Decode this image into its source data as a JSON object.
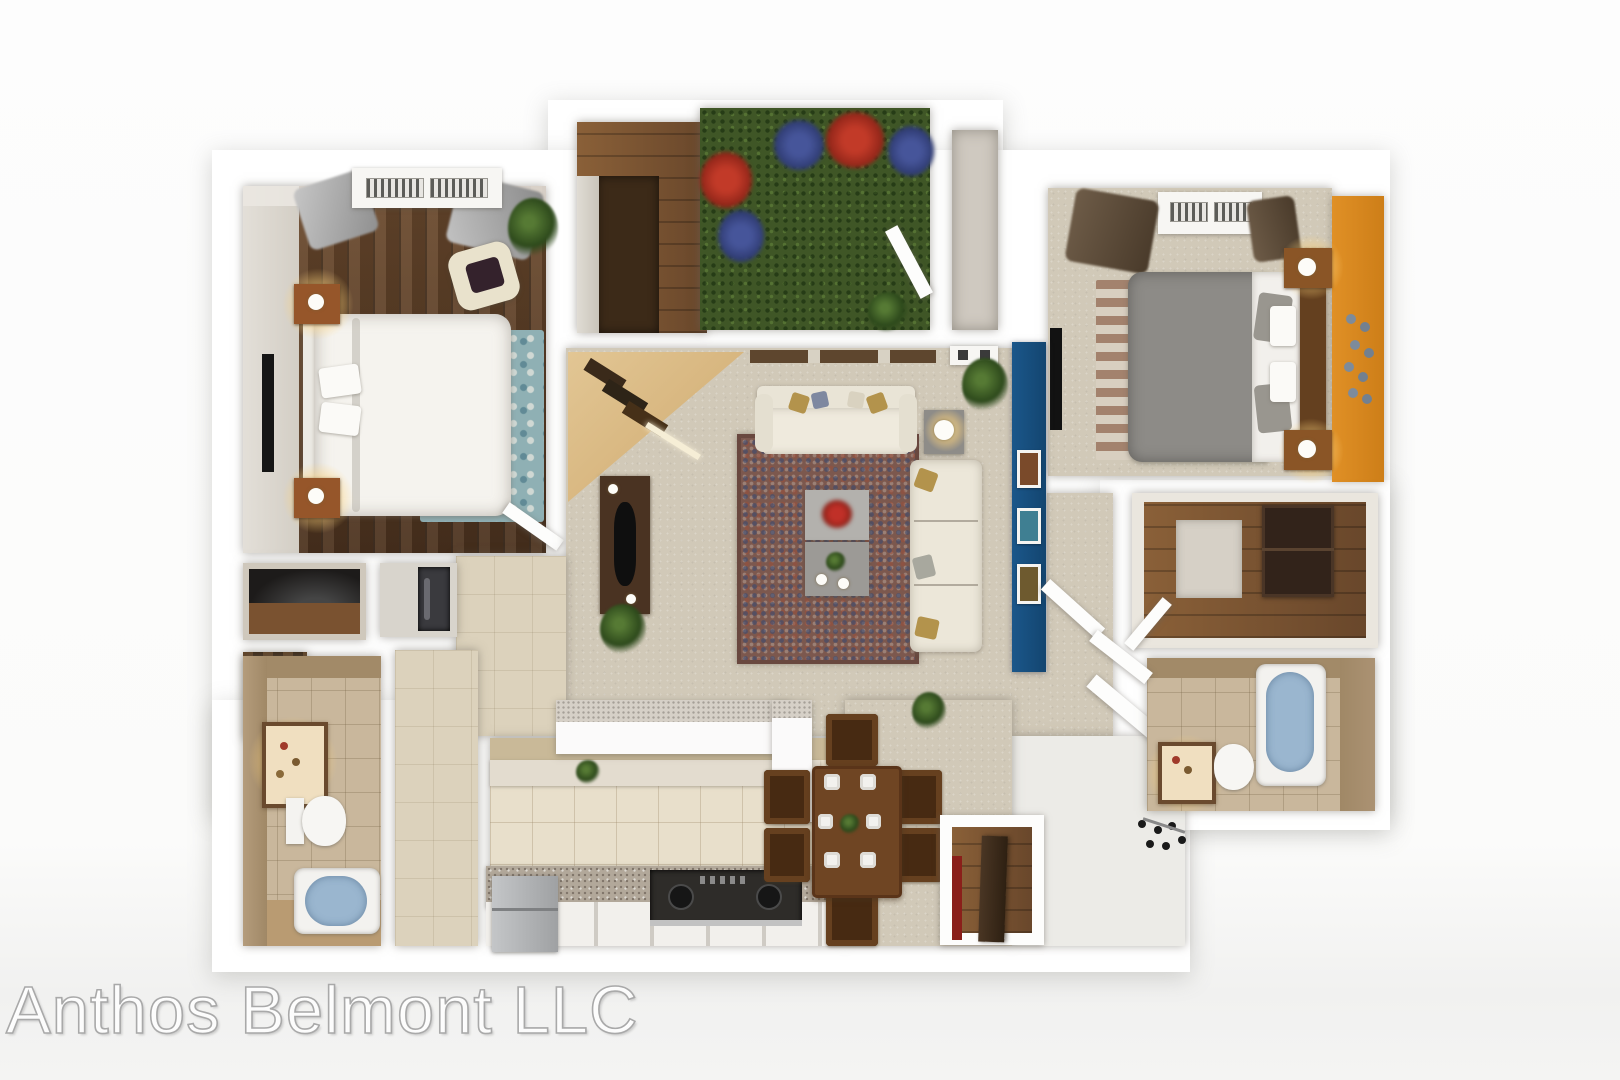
{
  "watermark": {
    "text": "Anthos Belmont LLC"
  },
  "plan": {
    "type": "3d-apartment-floor-plan",
    "bedrooms": 2,
    "bathrooms": 2,
    "rooms": [
      {
        "name": "master-bedroom",
        "floor": "dark wood plank",
        "fixtures": [
          "dresser",
          "curtains",
          "tv",
          "king-bed",
          "nightstand-with-lamp",
          "nightstand-with-lamp",
          "armchair",
          "teal-rug",
          "plant"
        ]
      },
      {
        "name": "laundry-closet",
        "floor": "medium wood",
        "fixtures": [
          "counter"
        ]
      },
      {
        "name": "patio",
        "floor": "grass",
        "fixtures": [
          "flower-bushes-red",
          "flower-bushes-blue",
          "patio-door"
        ]
      },
      {
        "name": "storage-closet",
        "floor": "gray tile",
        "fixtures": []
      },
      {
        "name": "bedroom-2",
        "floor": "beige carpet",
        "accent_wall": "orange",
        "fixtures": [
          "dresser",
          "curtains",
          "tv",
          "queen-bed",
          "nightstand-with-lamp",
          "nightstand-with-lamp",
          "striped-rug",
          "wall-decal-flowers"
        ]
      },
      {
        "name": "living-room",
        "floor": "beige carpet",
        "accent_wall": "blue",
        "fixtures": [
          "corner-desk",
          "media-console",
          "tv",
          "area-rug",
          "sofa",
          "chaise",
          "coffee-table",
          "side-table-lamp",
          "plants",
          "picture-frames"
        ]
      },
      {
        "name": "hallway",
        "floor": "tan tile",
        "fixtures": []
      },
      {
        "name": "linen-closet",
        "floor": "",
        "fixtures": [
          "black-top-counter"
        ]
      },
      {
        "name": "washer-dryer-closet",
        "floor": "",
        "fixtures": [
          "washer"
        ]
      },
      {
        "name": "storage-cabinet",
        "floor": "",
        "fixtures": [
          "wood-shelves"
        ]
      },
      {
        "name": "bathroom-1",
        "floor": "tan tile",
        "fixtures": [
          "lighted-vanity",
          "toilet",
          "bathtub"
        ]
      },
      {
        "name": "kitchen",
        "floor": "cream tile",
        "fixtures": [
          "bar-counter",
          "upper-counter",
          "stove",
          "lower-cabinets",
          "refrigerator"
        ]
      },
      {
        "name": "dining-area",
        "floor": "beige carpet",
        "fixtures": [
          "dining-table",
          "six-chairs",
          "plates",
          "centerpiece"
        ]
      },
      {
        "name": "entry",
        "floor": "white tile",
        "fixtures": [
          "coat-rack"
        ]
      },
      {
        "name": "pantry",
        "floor": "medium wood",
        "fixtures": [
          "wood-door",
          "red-rack"
        ]
      },
      {
        "name": "walk-in-closet",
        "floor": "wood panel",
        "fixtures": [
          "dresser"
        ]
      },
      {
        "name": "bathroom-2",
        "floor": "tan tile",
        "fixtures": [
          "lighted-vanity",
          "toilet",
          "bathtub"
        ]
      }
    ]
  },
  "palette": {
    "background": "#fbfbfa",
    "wall_white": "#ffffff",
    "wood_dark": "#5a3d26",
    "wood_medium": "#7a5434",
    "carpet_beige": "#d1c9b8",
    "tile_cream": "#e8dfcb",
    "tile_tan": "#c9b79c",
    "grass_green": "#3f5626",
    "accent_blue_wall": "#174f7d",
    "accent_orange_wall": "#dd8a1f",
    "bath_water_blue": "#9ab6cf",
    "rug_teal": "#8fb0b4",
    "rug_red_blue": "#7c584e",
    "sofa_cream": "#ece7d9",
    "dining_wood": "#6f4523",
    "flower_red": "#b83026",
    "flower_blue": "#3c4e8c"
  }
}
